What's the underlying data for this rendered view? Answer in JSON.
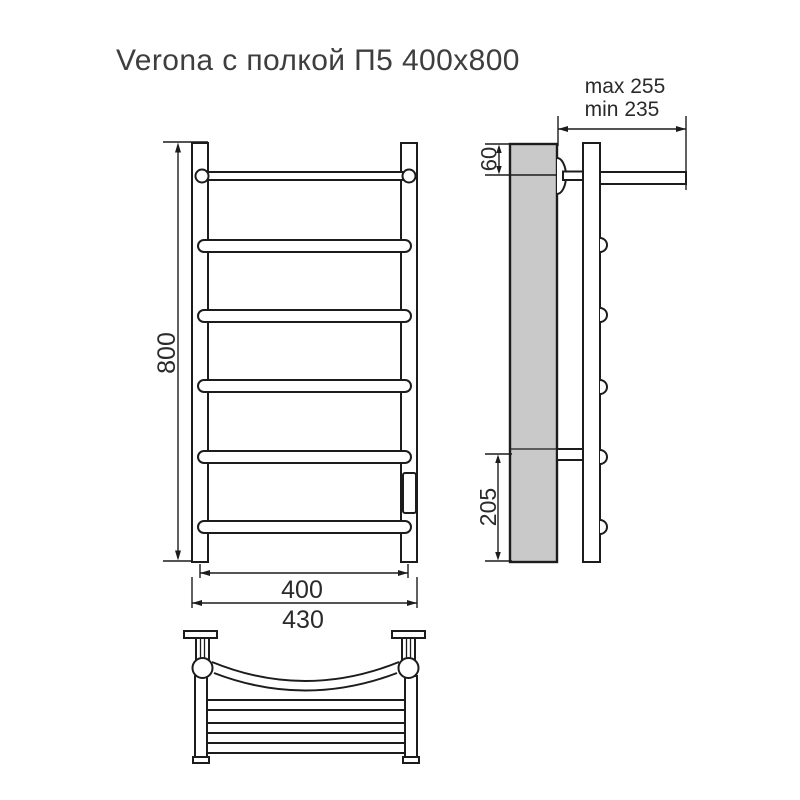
{
  "title": "Verona с полкой П5 400x800",
  "colors": {
    "line": "#1c1c1c",
    "wall_fill": "#c9c9c9",
    "title_color": "#3e3e3e",
    "background": "#ffffff"
  },
  "views": {
    "front": {
      "name": "front elevation",
      "rung_count": 6,
      "dims": {
        "height": "800",
        "rail_width": "400",
        "overall_width": "430"
      }
    },
    "side": {
      "name": "side profile",
      "dims": {
        "shelf_drop": "60",
        "lower_section": "205",
        "depth_max": "max 255",
        "depth_min": "min 235"
      }
    },
    "plan": {
      "name": "shelf top view"
    }
  }
}
